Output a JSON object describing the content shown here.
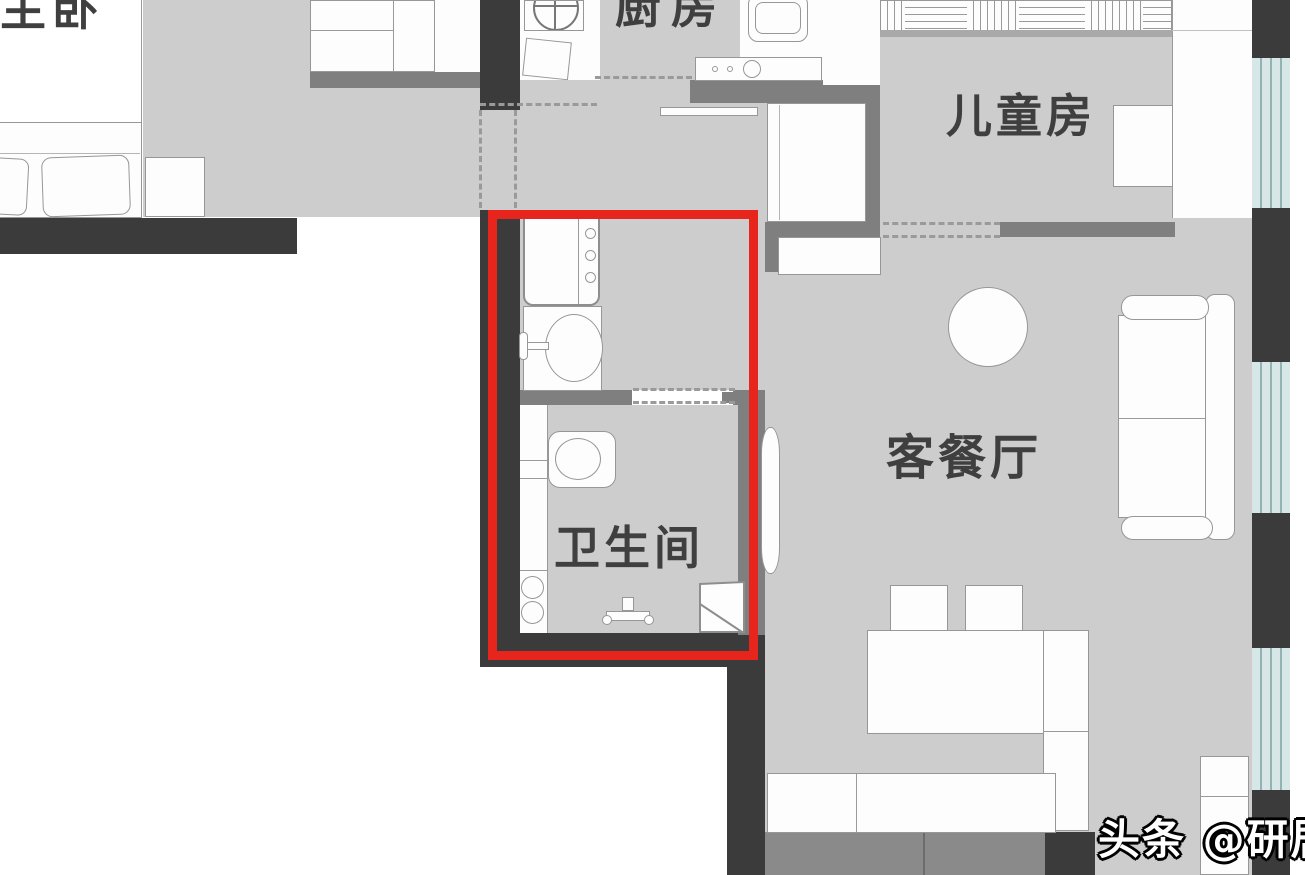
{
  "type": "floor-plan",
  "labels": {
    "master_bedroom": "主卧",
    "kitchen": "厨房",
    "children_room": "儿童房",
    "living_dining": "客餐厅",
    "bathroom": "卫生间"
  },
  "watermark": {
    "text": "头条 @研居"
  },
  "highlight": {
    "shape": "rectangle",
    "color": "#e8251c",
    "highlights": "bathroom-and-laundry-zone"
  },
  "colors": {
    "background": "#ffffff",
    "floor": "#cdcdcd",
    "wall_dark": "#3b3b3b",
    "wall_mid": "#7f7f7f",
    "window": "#d7e7e7",
    "highlight_red": "#e8251c",
    "label_text": "#3f3f3f"
  },
  "fixtures": [
    "bed",
    "pillows",
    "nightstand",
    "wardrobe",
    "desk",
    "stove",
    "kitchen-sink",
    "kitchen-counter",
    "washing-machine",
    "washbasin",
    "toilet",
    "shower-set",
    "corner-shelf",
    "sliding-door",
    "fridge",
    "shoe-cabinet",
    "round-table",
    "sofa",
    "dining-table",
    "dining-chairs",
    "corner-bench",
    "side-cabinet",
    "bay-window"
  ]
}
